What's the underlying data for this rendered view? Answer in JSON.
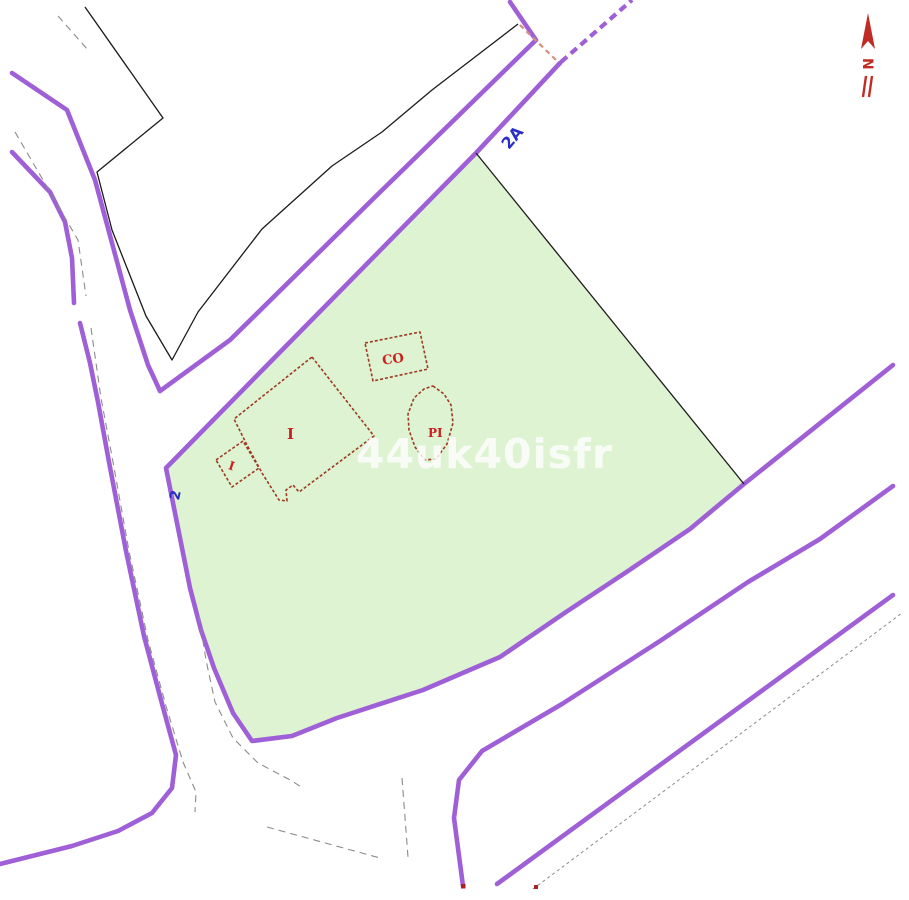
{
  "map": {
    "type": "cadastral-parcel-map",
    "background_color": "#ffffff",
    "parcel": {
      "number": "2",
      "fill_color": "#def3d1",
      "outline_color": "#9f5fd6"
    },
    "road": {
      "name": "2A",
      "edge_color": "#9f5fd6"
    },
    "labels": {
      "road_2a": "2A",
      "parcel_2": "2",
      "building_main": "I",
      "building_annex": "I",
      "building_co": "CO",
      "building_pi": "PI"
    },
    "buildings": {
      "outline_color": "#9c3a22",
      "label_color": "#cc2020"
    },
    "boundary_line_color": "#1b1b1b",
    "centerline_color": "#8b8b8b",
    "dashed_link_color": "#d4907c",
    "blue_label_color": "#2a2ec4",
    "watermark": {
      "text": "44uk40isfr",
      "color": "#ffffff"
    },
    "north_arrow": {
      "letter": "N",
      "color": "#c22b24"
    },
    "markers": {
      "dot_color": "#aa2222"
    }
  }
}
